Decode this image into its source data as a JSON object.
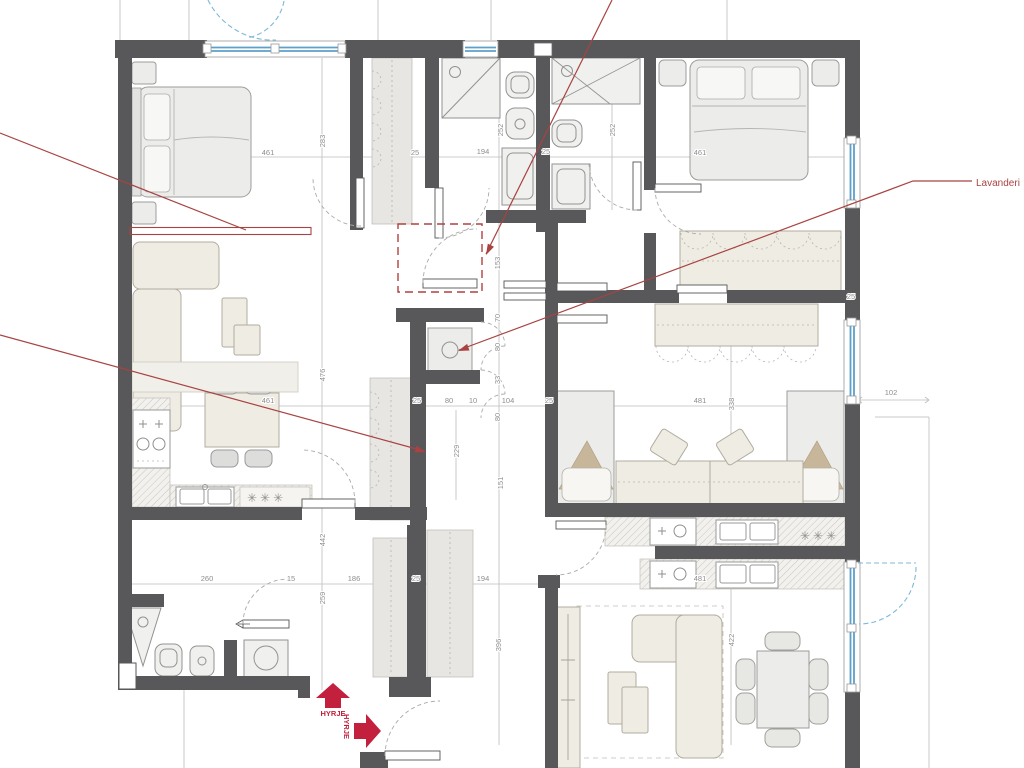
{
  "labels": {
    "lavanderi": "Lavanderi",
    "hyrje_up": "HYRJE",
    "hyrje_right": "HYRJE"
  },
  "symbols": {
    "fridge_left": "✳✳✳",
    "fridge_right": "✳✳✳"
  },
  "colors": {
    "wall": "#58575a",
    "red_annotation": "#a84341",
    "entry_arrow": "#c2203d",
    "window_glass": "#5ba0c9",
    "balcony_dash": "#7db8d8"
  },
  "dim_labels": [
    {
      "t": "461",
      "x": 268,
      "y": 155
    },
    {
      "t": "25",
      "x": 415,
      "y": 155
    },
    {
      "t": "194",
      "x": 483,
      "y": 154
    },
    {
      "t": "25",
      "x": 546,
      "y": 154
    },
    {
      "t": "461",
      "x": 700,
      "y": 155
    },
    {
      "t": "283",
      "x": 325,
      "y": 141,
      "rot": -90
    },
    {
      "t": "252",
      "x": 503,
      "y": 130,
      "rot": -90
    },
    {
      "t": "252",
      "x": 615,
      "y": 130,
      "rot": -90
    },
    {
      "t": "153",
      "x": 500,
      "y": 263,
      "rot": -90
    },
    {
      "t": "70",
      "x": 500,
      "y": 318,
      "rot": -90
    },
    {
      "t": "80",
      "x": 500,
      "y": 347,
      "rot": -90
    },
    {
      "t": "33",
      "x": 500,
      "y": 380,
      "rot": -90
    },
    {
      "t": "80",
      "x": 500,
      "y": 417,
      "rot": -90
    },
    {
      "t": "229",
      "x": 459,
      "y": 451,
      "rot": -90
    },
    {
      "t": "151",
      "x": 503,
      "y": 483,
      "rot": -90
    },
    {
      "t": "476",
      "x": 325,
      "y": 375,
      "rot": -90
    },
    {
      "t": "461",
      "x": 268,
      "y": 403
    },
    {
      "t": "25",
      "x": 417,
      "y": 403
    },
    {
      "t": "80",
      "x": 449,
      "y": 403
    },
    {
      "t": "10",
      "x": 473,
      "y": 403
    },
    {
      "t": "104",
      "x": 508,
      "y": 403
    },
    {
      "t": "25",
      "x": 549,
      "y": 403
    },
    {
      "t": "481",
      "x": 700,
      "y": 403
    },
    {
      "t": "338",
      "x": 734,
      "y": 404,
      "rot": -90
    },
    {
      "t": "102",
      "x": 891,
      "y": 395
    },
    {
      "t": "25",
      "x": 851,
      "y": 299
    },
    {
      "t": "442",
      "x": 325,
      "y": 540,
      "rot": -90
    },
    {
      "t": "259",
      "x": 325,
      "y": 598,
      "rot": -90
    },
    {
      "t": "260",
      "x": 207,
      "y": 581
    },
    {
      "t": "15",
      "x": 291,
      "y": 581
    },
    {
      "t": "186",
      "x": 354,
      "y": 581
    },
    {
      "t": "25",
      "x": 416,
      "y": 581
    },
    {
      "t": "194",
      "x": 483,
      "y": 581
    },
    {
      "t": "481",
      "x": 700,
      "y": 581
    },
    {
      "t": "396",
      "x": 501,
      "y": 645,
      "rot": -90
    },
    {
      "t": "422",
      "x": 734,
      "y": 640,
      "rot": -90
    }
  ]
}
